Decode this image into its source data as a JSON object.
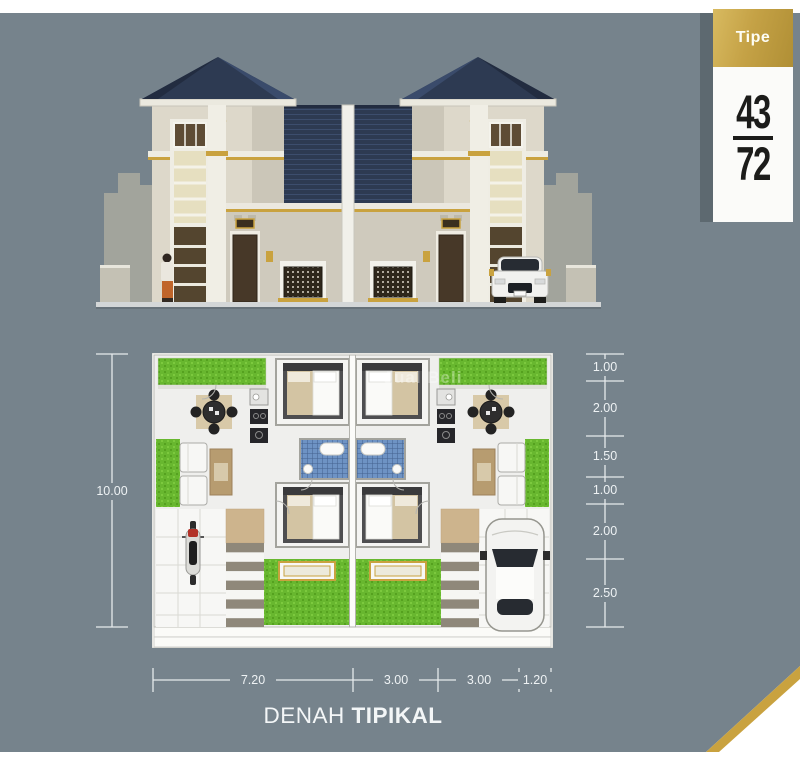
{
  "badge": {
    "label": "Tipe",
    "numerator": "43",
    "denominator": "72"
  },
  "title": {
    "word1": "DENAH",
    "word2": "TIPIKAL"
  },
  "watermark": {
    "text": "Jual Beli"
  },
  "dimensions": {
    "left_total": "10.00",
    "right_segments": [
      "1.00",
      "2.00",
      "1.50",
      "1.00",
      "2.00",
      "2.50"
    ],
    "bottom_segments": [
      "7.20",
      "3.00",
      "3.00",
      "1.20"
    ]
  },
  "drawing": {
    "elevation": "twin two-storey house facade with hip roofs, person at left, white car at right",
    "floor_plan": "two mirrored units: garden, dining, kitchen, two bedrooms, bathroom, living room, stairs, carport with motorcycle (left) and car (right)"
  },
  "colors": {
    "canvas": "#76838C",
    "ribbon_gold": "#C5A246",
    "roof_navy": "#2D3A52",
    "grass_green": "#68B72F",
    "bath_blue": "#6E93C4",
    "accent_gold": "#C9A23F"
  }
}
